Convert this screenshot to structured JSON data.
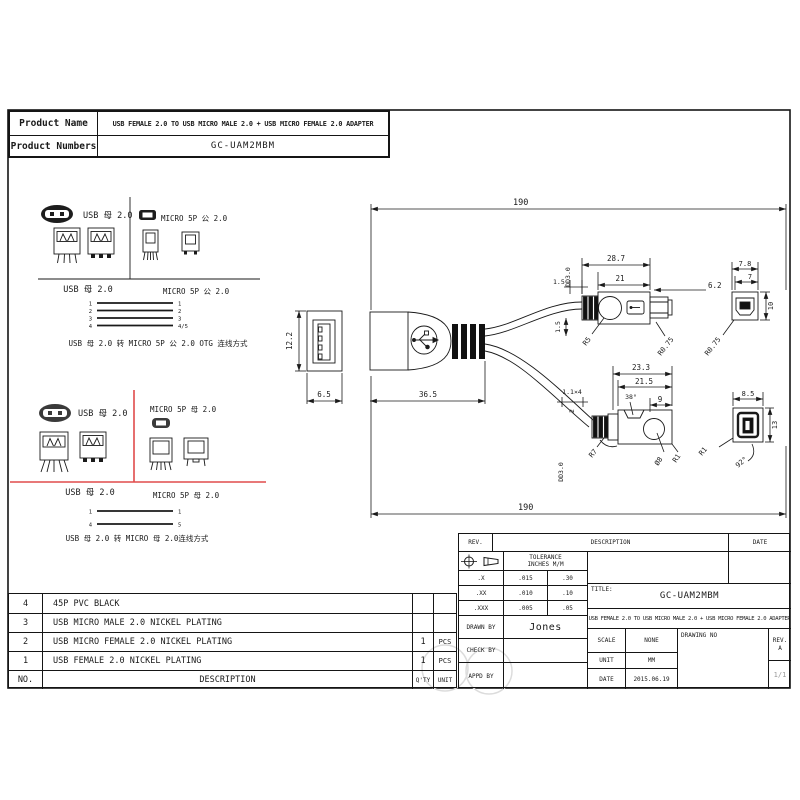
{
  "product_table": {
    "name_label": "Product Name",
    "name_value": "USB FEMALE 2.0 TO USB MICRO MALE 2.0 + USB MICRO FEMALE 2.0 ADAPTER",
    "numbers_label": "Product Numbers",
    "numbers_value": "GC-UAM2MBM"
  },
  "pinout_panel": {
    "top": {
      "usb_icon_label": "USB 母 2.0",
      "micro_icon_label": "MICRO 5P 公 2.0",
      "usb_view_label": "USB 母 2.0",
      "micro_view_label": "MICRO 5P 公 2.0",
      "wire_pins_left": [
        "1",
        "2",
        "3",
        "4"
      ],
      "wire_pins_right": [
        "1",
        "2",
        "3",
        "4/5"
      ],
      "caption": "USB 母 2.0 转 MICRO 5P 公 2.0 OTG  连线方式"
    },
    "bottom": {
      "usb_icon_label": "USB 母 2.0",
      "micro_icon_label": "MICRO 5P 母 2.0",
      "usb_view_label": "USB 母 2.0",
      "micro_view_label": "MICRO 5P 母 2.0",
      "wire_pins_left": [
        "1",
        "4"
      ],
      "wire_pins_right": [
        "1",
        "5"
      ],
      "caption": "USB 母 2.0 转  MICRO 母 2.0连线方式"
    }
  },
  "drawing": {
    "overall_length": "190",
    "usb_height": "12.2",
    "usb_width": "6.5",
    "usb_body_length": "36.5",
    "cable_dia": "DD3.0",
    "d1_5": "1.5",
    "d28_7": "28.7",
    "d21": "21",
    "d6_2": "6.2",
    "r5": "R5",
    "r0_75": "R0.75",
    "d7_8": "7.8",
    "d7": "7",
    "d10": "10",
    "d1_1x4": "1.1×4",
    "d2": "2",
    "d23_3": "23.3",
    "d21_5": "21.5",
    "a38": "38°",
    "d9": "9",
    "r7": "R7",
    "dia8": "Ø8",
    "r1": "R1",
    "d8_5": "8.5",
    "d13": "13",
    "a92": "92°"
  },
  "parts_table": {
    "headers": {
      "no": "NO.",
      "desc": "DESCRIPTION",
      "qty": "Q'TY",
      "unit": "UNIT"
    },
    "rows": [
      {
        "no": "4",
        "desc": "45P PVC BLACK",
        "qty": "",
        "unit": ""
      },
      {
        "no": "3",
        "desc": "USB MICRO MALE 2.0 NICKEL PLATING",
        "qty": "",
        "unit": ""
      },
      {
        "no": "2",
        "desc": "USB MICRO FEMALE 2.0 NICKEL PLATING",
        "qty": "1",
        "unit": "PCS"
      },
      {
        "no": "1",
        "desc": "USB FEMALE 2.0 NICKEL PLATING",
        "qty": "1",
        "unit": "PCS"
      }
    ]
  },
  "title_block": {
    "rev_label": "REV.",
    "description_label": "DESCRIPTION",
    "date_label": "DATE",
    "tolerance_line1": "TOLERANCE",
    "tolerance_line2": "INCHES  M/M",
    "tol_rows": [
      {
        "p": ".X",
        "in": ".015",
        "mm": ".30"
      },
      {
        "p": ".XX",
        "in": ".010",
        "mm": ".10"
      },
      {
        "p": ".XXX",
        "in": ".005",
        "mm": ".05"
      }
    ],
    "drawn_by_label": "DRAWN BY",
    "drawn_by_value": "Jones",
    "check_by_label": "CHECK BY",
    "appd_by_label": "APPD BY",
    "title_label": "TITLE:",
    "title_value": "GC-UAM2MBM",
    "subtitle": "USB FEMALE 2.0 TO USB MICRO MALE 2.0 + USB MICRO FEMALE 2.0 ADAPTER",
    "scale_label": "SCALE",
    "scale_value": "NONE",
    "drawing_no_label": "DRAWING NO",
    "rev2_label": "REV.",
    "rev_value": "A",
    "unit_label": "UNIT",
    "unit_value": "MM",
    "date2_label": "DATE",
    "date_value": "2015.06.19",
    "sheet": "1/1"
  },
  "colors": {
    "line": "#1a1a1a",
    "red_divider": "#e04b4b",
    "faded_text": "#8a8a8a",
    "watermark": "#dcdcdc"
  }
}
